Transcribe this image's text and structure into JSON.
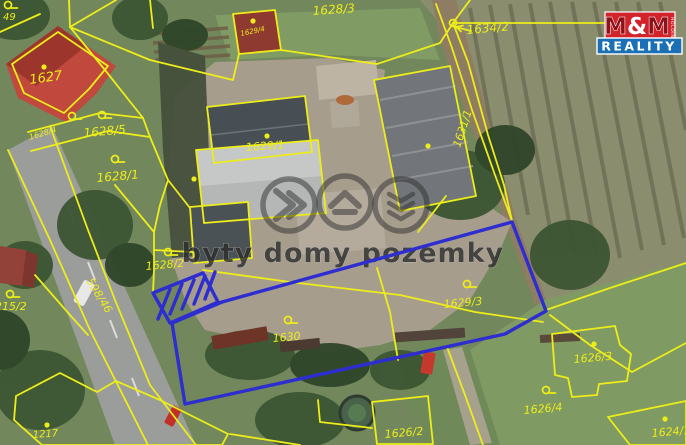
{
  "map": {
    "watermark": {
      "text": "byty domy pozemky"
    },
    "logo": {
      "m1": "M",
      "amp": "&",
      "m2": "M",
      "holding": "HOLDING",
      "reality": "REALITY"
    },
    "colors": {
      "parcel_line": "#eded1a",
      "highlight": "#2d2dd0",
      "watermark": "#2d2d2d",
      "logo_red": "#d2232a",
      "logo_blue": "#1a6fb5",
      "logo_maroon": "#8c1118"
    },
    "icons": {
      "watermark_circle_1": "double-chevron-right-icon",
      "watermark_circle_2": "house-icon",
      "watermark_circle_3": "stacked-chevrons-icon",
      "label_pointer": "arrow-left-icon"
    },
    "parcel_labels": [
      {
        "text": "49",
        "x": 3,
        "y": 20,
        "size": 10,
        "rot": 0
      },
      {
        "text": "1627",
        "x": 30,
        "y": 84,
        "size": 13,
        "rot": -8
      },
      {
        "text": "1628/5",
        "x": 84,
        "y": 137,
        "size": 12,
        "rot": -5
      },
      {
        "text": "1628/4",
        "x": 30,
        "y": 140,
        "size": 8,
        "rot": -17
      },
      {
        "text": "1628/1",
        "x": 97,
        "y": 182,
        "size": 12,
        "rot": -5
      },
      {
        "text": "1628/2",
        "x": 146,
        "y": 270,
        "size": 11,
        "rot": -5
      },
      {
        "text": "1628/3",
        "x": 313,
        "y": 15,
        "size": 12,
        "rot": -4
      },
      {
        "text": "1629/4",
        "x": 241,
        "y": 36,
        "size": 7,
        "rot": -12
      },
      {
        "text": "1629/1",
        "x": 246,
        "y": 151,
        "size": 11,
        "rot": -4
      },
      {
        "text": "1634/2",
        "x": 467,
        "y": 34,
        "size": 12,
        "rot": -5
      },
      {
        "text": "1631/1",
        "x": 460,
        "y": 148,
        "size": 11,
        "rot": -72
      },
      {
        "text": "1629/3",
        "x": 444,
        "y": 308,
        "size": 11,
        "rot": -5
      },
      {
        "text": "1630",
        "x": 273,
        "y": 342,
        "size": 11,
        "rot": -5
      },
      {
        "text": "1626/3",
        "x": 574,
        "y": 363,
        "size": 11,
        "rot": -5
      },
      {
        "text": "1626/4",
        "x": 524,
        "y": 414,
        "size": 11,
        "rot": -5
      },
      {
        "text": "1626/2",
        "x": 385,
        "y": 438,
        "size": 11,
        "rot": -5
      },
      {
        "text": "1624/1",
        "x": 652,
        "y": 437,
        "size": 11,
        "rot": -5
      },
      {
        "text": "1217",
        "x": 33,
        "y": 438,
        "size": 10,
        "rot": -4
      },
      {
        "text": "1215/2",
        "x": -12,
        "y": 310,
        "size": 11,
        "rot": 0
      },
      {
        "text": "598/46",
        "x": 86,
        "y": 281,
        "size": 11,
        "rot": 58
      }
    ],
    "symbols": {
      "omega": [
        [
          72,
          116
        ],
        [
          102,
          115
        ],
        [
          115,
          159
        ],
        [
          168,
          252
        ],
        [
          288,
          320
        ],
        [
          467,
          284
        ],
        [
          546,
          390
        ],
        [
          10,
          294
        ],
        [
          8,
          5
        ]
      ],
      "junction_circles": [
        [
          453,
          23
        ],
        [
          662,
          23
        ]
      ],
      "building_dots": [
        [
          44,
          67
        ],
        [
          253,
          21
        ],
        [
          267,
          136
        ],
        [
          194,
          179
        ],
        [
          428,
          146
        ],
        [
          594,
          344
        ],
        [
          47,
          425
        ],
        [
          665,
          419
        ]
      ]
    },
    "highlight": {
      "main_polygon": [
        [
          172,
          323
        ],
        [
          222,
          302
        ],
        [
          512,
          222
        ],
        [
          546,
          311
        ],
        [
          505,
          334
        ],
        [
          185,
          404
        ]
      ],
      "hatch_polygon": [
        [
          153,
          293
        ],
        [
          203,
          273
        ],
        [
          218,
          302
        ],
        [
          170,
          323
        ]
      ],
      "hatch_lines": [
        [
          158,
          319,
          170,
          289
        ],
        [
          170,
          314,
          182,
          284
        ],
        [
          182,
          309,
          194,
          280
        ],
        [
          194,
          304,
          205,
          276
        ],
        [
          205,
          299,
          215,
          272
        ]
      ]
    }
  }
}
